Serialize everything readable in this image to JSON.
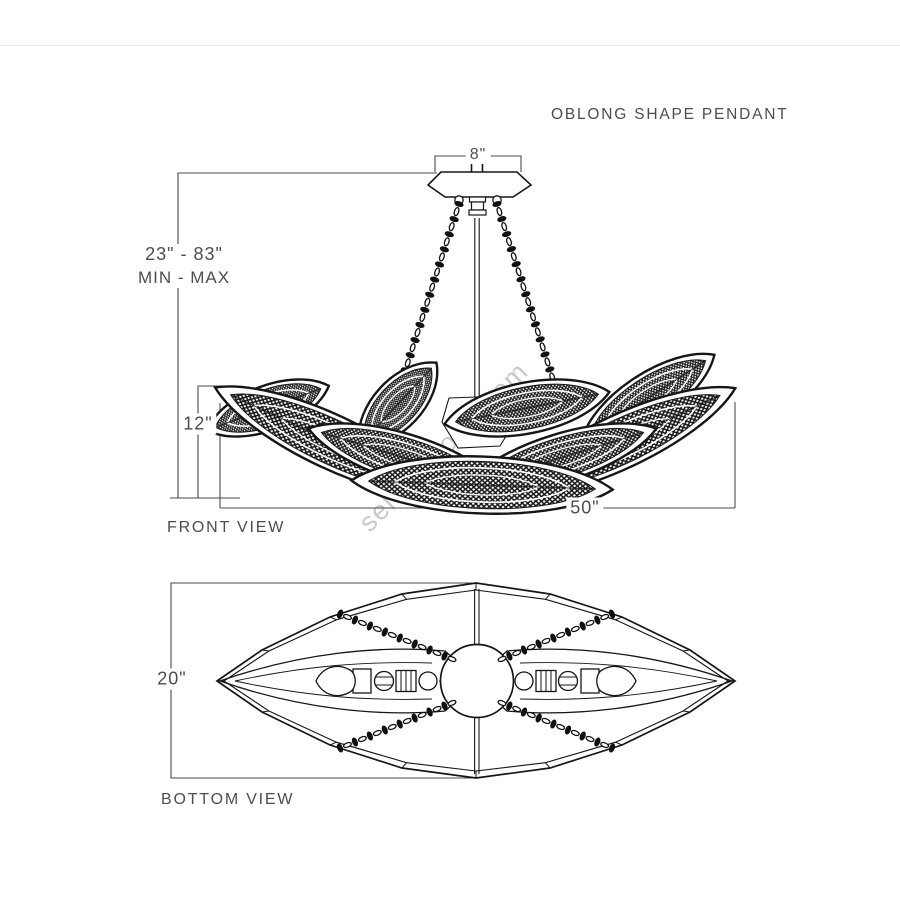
{
  "title": "OBLONG SHAPE PENDANT",
  "watermark": "select-world.com",
  "front_view": {
    "label": "FRONT VIEW",
    "dimensions": {
      "canopy_width": "8\"",
      "height_range": "23\" - 83\"",
      "height_range_caption": "MIN - MAX",
      "bowl_height": "12\"",
      "width": "50\""
    }
  },
  "bottom_view": {
    "label": "BOTTOM VIEW",
    "dimensions": {
      "depth": "20\""
    }
  },
  "colors": {
    "line_art": "#181818",
    "dimension_lines": "#4b4b4b",
    "text": "#4d4d4d",
    "watermark": "#c3bfbb",
    "background": "#ffffff"
  }
}
